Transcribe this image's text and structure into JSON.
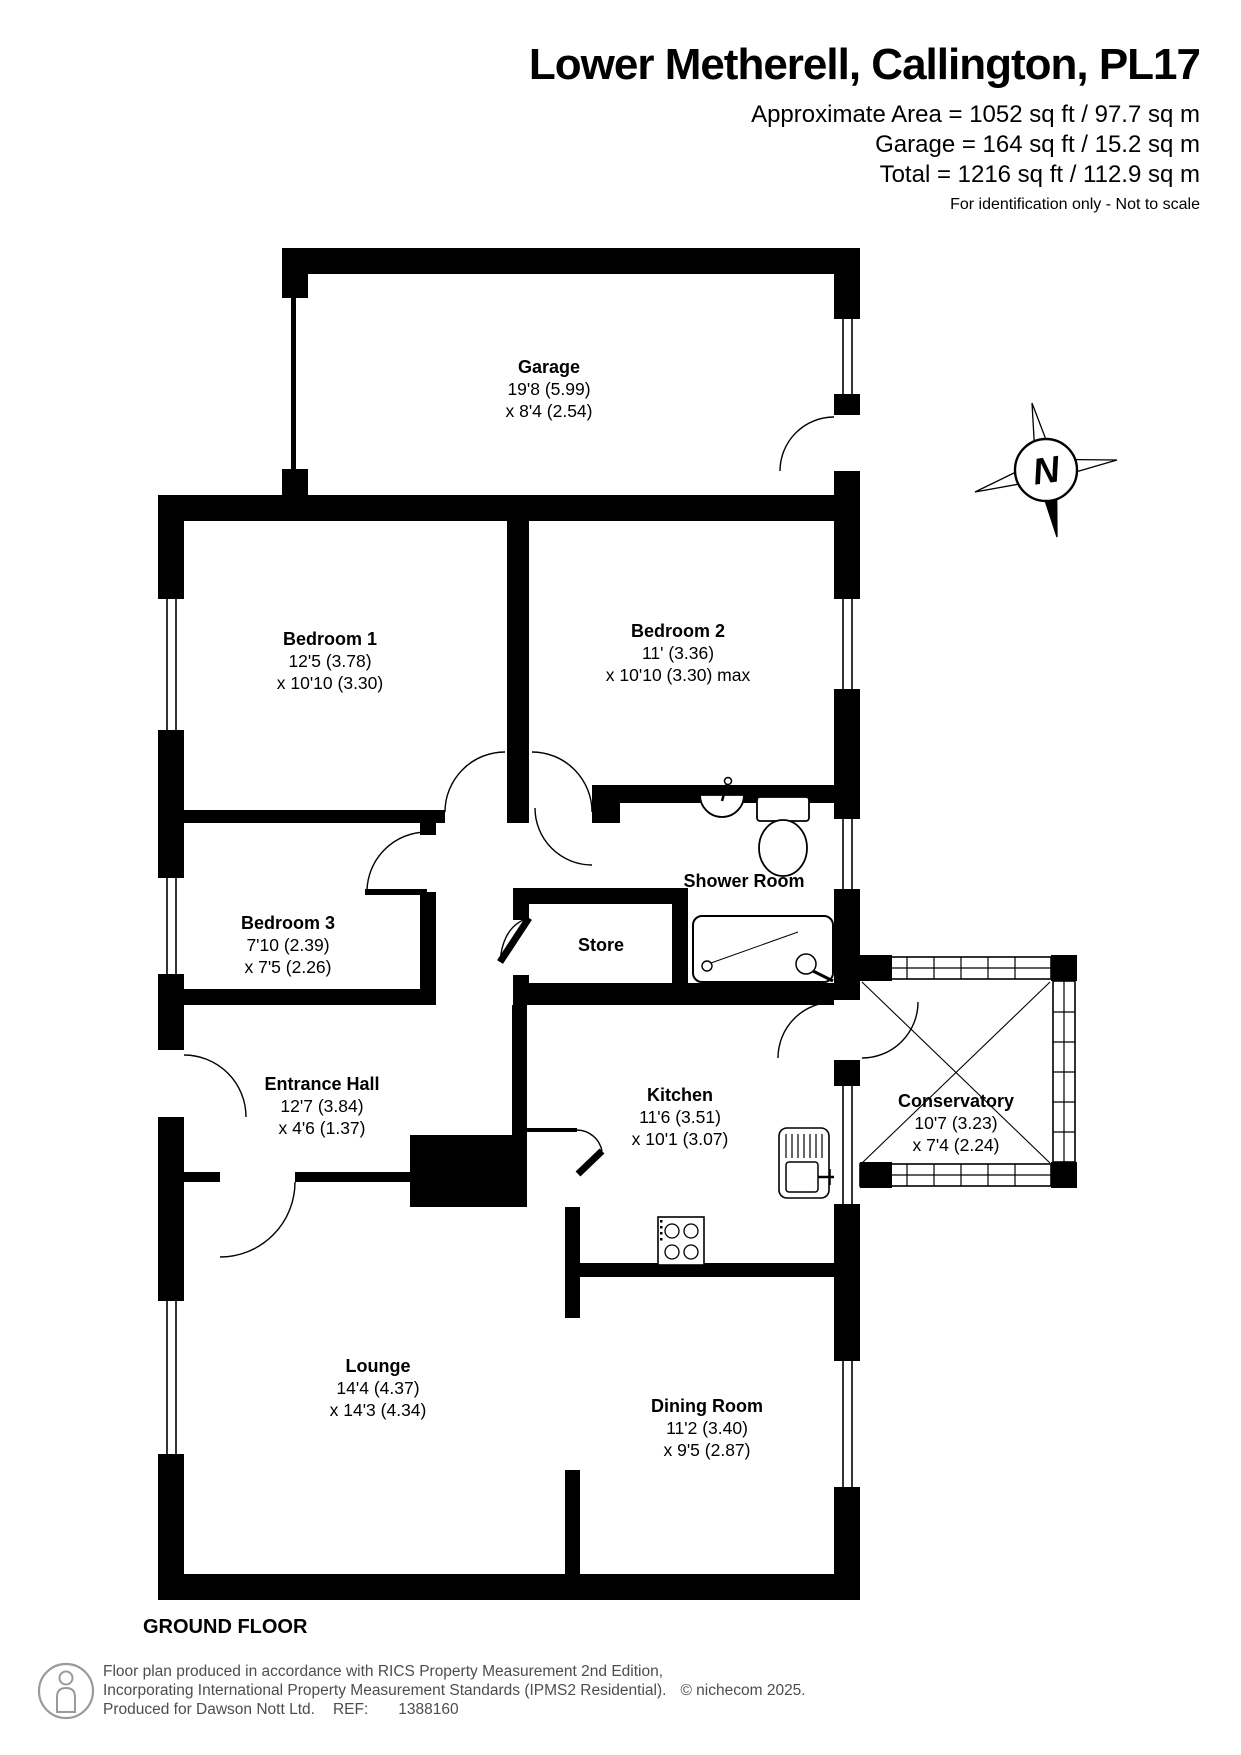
{
  "header": {
    "title": "Lower Metherell, Callington, PL17",
    "area_line1": "Approximate Area = 1052 sq ft / 97.7 sq m",
    "area_line2": "Garage = 164 sq ft / 15.2 sq m",
    "area_line3": "Total = 1216 sq ft / 112.9 sq m",
    "note": "For identification only - Not to scale"
  },
  "compass": {
    "label": "N"
  },
  "rooms": [
    {
      "id": "garage",
      "name": "Garage",
      "dim1": "19'8 (5.99)",
      "dim2": "x 8'4 (2.54)"
    },
    {
      "id": "bedroom1",
      "name": "Bedroom 1",
      "dim1": "12'5 (3.78)",
      "dim2": "x 10'10 (3.30)"
    },
    {
      "id": "bedroom2",
      "name": "Bedroom 2",
      "dim1": "11' (3.36)",
      "dim2": "x 10'10 (3.30) max"
    },
    {
      "id": "bedroom3",
      "name": "Bedroom 3",
      "dim1": "7'10 (2.39)",
      "dim2": "x 7'5 (2.26)"
    },
    {
      "id": "shower",
      "name": "Shower Room",
      "dim1": "",
      "dim2": ""
    },
    {
      "id": "store",
      "name": "Store",
      "dim1": "",
      "dim2": ""
    },
    {
      "id": "entrance",
      "name": "Entrance Hall",
      "dim1": "12'7 (3.84)",
      "dim2": "x 4'6 (1.37)"
    },
    {
      "id": "kitchen",
      "name": "Kitchen",
      "dim1": "11'6 (3.51)",
      "dim2": "x 10'1 (3.07)"
    },
    {
      "id": "conservatory",
      "name": "Conservatory",
      "dim1": "10'7 (3.23)",
      "dim2": "x 7'4 (2.24)"
    },
    {
      "id": "lounge",
      "name": "Lounge",
      "dim1": "14'4 (4.37)",
      "dim2": "x 14'3 (4.34)"
    },
    {
      "id": "dining",
      "name": "Dining Room",
      "dim1": "11'2 (3.40)",
      "dim2": "x 9'5 (2.87)"
    }
  ],
  "floor_label": "GROUND FLOOR",
  "footer": {
    "line1": "Floor plan produced in accordance with RICS Property Measurement 2nd Edition,",
    "line2": "Incorporating International Property Measurement Standards (IPMS2 Residential).",
    "copyright": "© nichecom 2025.",
    "produced_for": "Produced for Dawson Nott Ltd.",
    "ref_label": "REF:",
    "ref_value": "1388160"
  },
  "colors": {
    "wall": "#000000",
    "text": "#000000",
    "footer_text": "#4d4d4d",
    "logo_gray": "#9a9a9a"
  }
}
